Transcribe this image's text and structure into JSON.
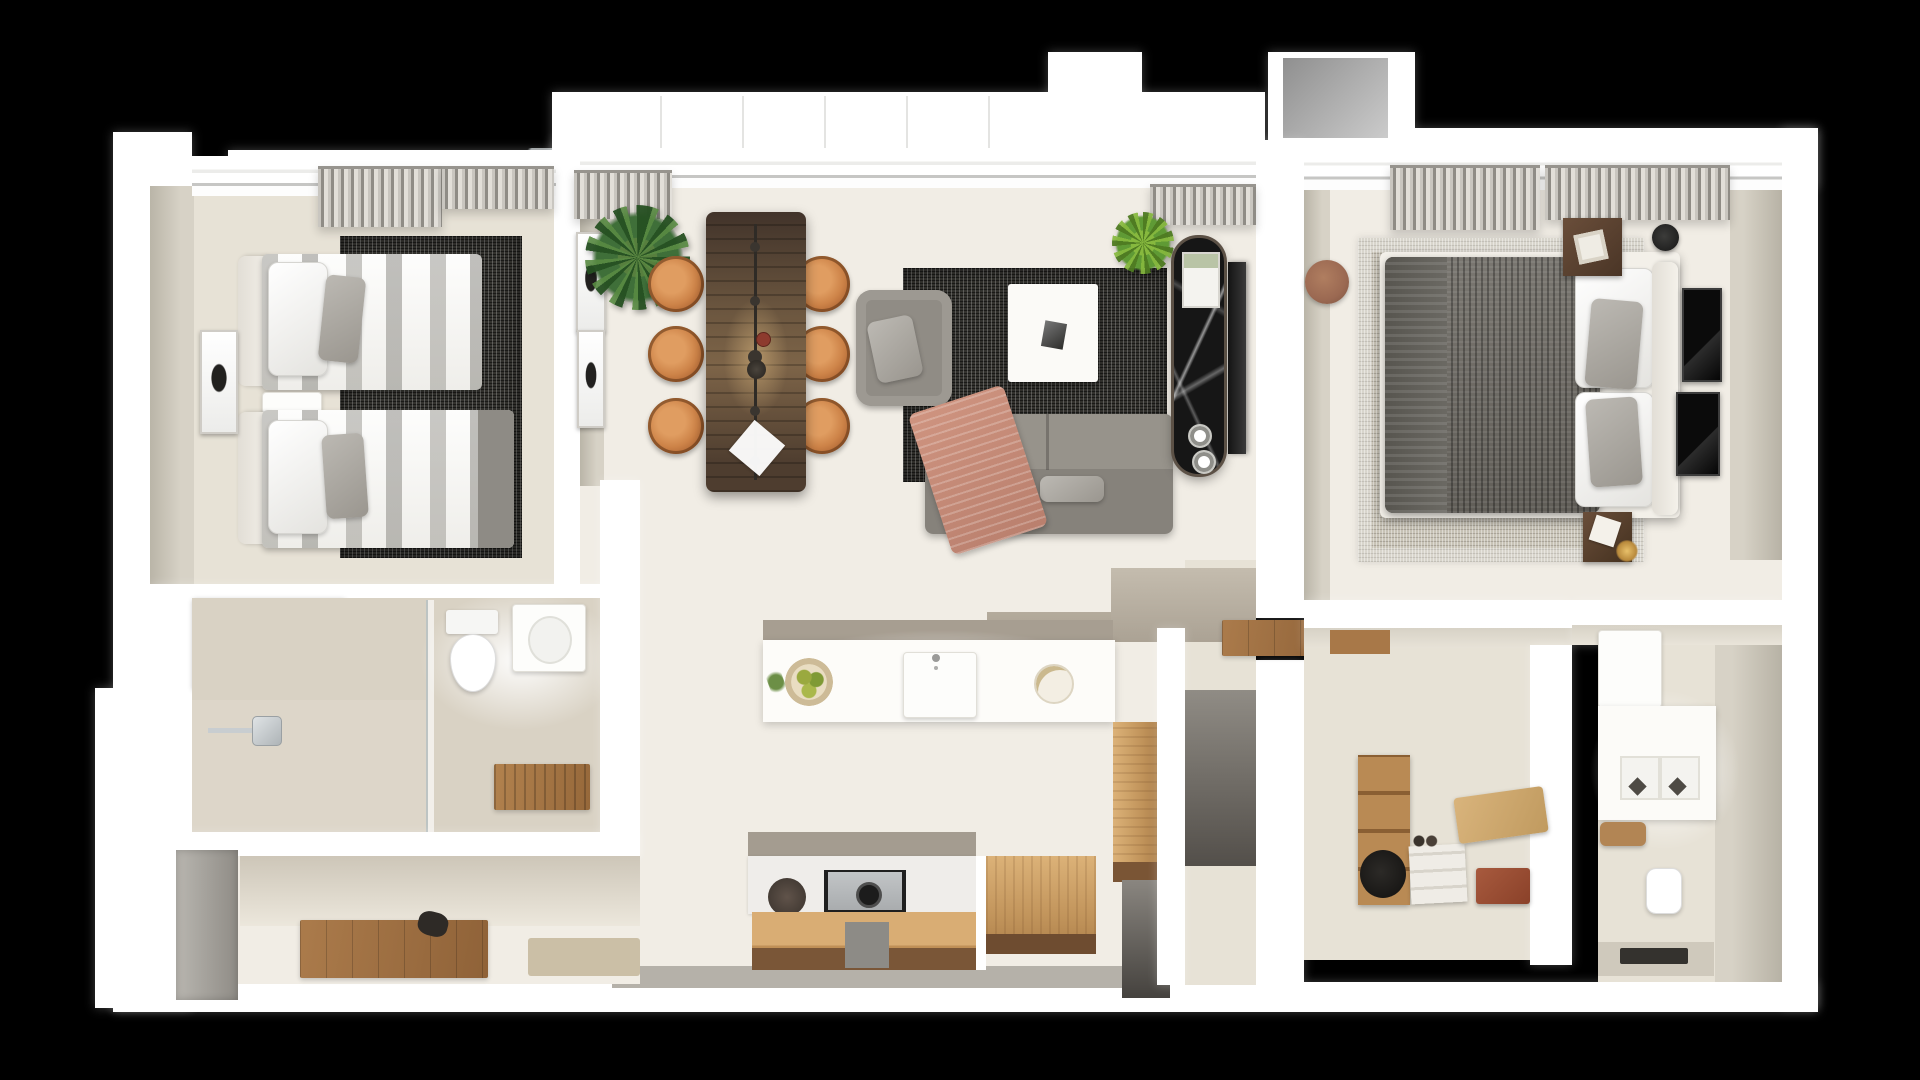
{
  "scene": {
    "description": "Top-down 3D dollhouse render of a two-bedroom apartment floor plan on a black background",
    "view": "top-down architectural render",
    "background": "#000000"
  },
  "palette": {
    "bg": "#000000",
    "wall": "#ffffff",
    "wall-face": "#d7d2c6",
    "floor": "#f1ede5",
    "floor-dim": "#e7e2d6",
    "tile": "#d9d2c4",
    "wood": "#d0a265",
    "wood-deep": "#7a5535",
    "table-wood": "#5d4a38",
    "chair-tan": "#c97f44",
    "sofa-gray": "#8b877f",
    "rug-dark": "#33322e",
    "rug-light": "#c8c3b6",
    "duvet-gray": "#6e6c66",
    "throw-blush": "#c48d7a",
    "marble-black": "#161616",
    "plant-green": "#4c7d3c",
    "plant-bright": "#76ab3a",
    "pouf-brown": "#9b6952",
    "door-gray": "#8f8c86"
  },
  "rooms": [
    {
      "id": "bedroom-2",
      "label": "Twin Bedroom",
      "furniture": [
        "twin bed x2",
        "upholstered headboards",
        "white and gray striped bedding",
        "gray accent pillows",
        "bedside shelf",
        "charcoal textured rug",
        "tall wall art",
        "gray curtains",
        "oak wardrobe"
      ]
    },
    {
      "id": "bathroom-1",
      "label": "Bathroom",
      "furniture": [
        "walk-in shower",
        "rain shower arm",
        "glass screen",
        "toilet",
        "washbasin",
        "teak duckboard mat"
      ]
    },
    {
      "id": "entry-hall",
      "label": "Entry Hall",
      "furniture": [
        "gray entry door",
        "wooden doormat",
        "keys on mat",
        "beige mat"
      ]
    },
    {
      "id": "living-dining",
      "label": "Living / Dining Room",
      "furniture": [
        "dark walnut dining table",
        "linear pendant light",
        "round tan leather chairs x6",
        "palm plant",
        "wall art x2",
        "gray armchair",
        "charcoal rug",
        "white coffee table",
        "gray sectional sofa",
        "blush throw blanket",
        "pothos plant",
        "black marble media console",
        "wall mounted tv"
      ]
    },
    {
      "id": "kitchen",
      "label": "Kitchen",
      "furniture": [
        "island with sink",
        "fruit bowl",
        "serving plate",
        "gas cooktop",
        "dark round platter",
        "oak base cabinets",
        "tall oak cabinet",
        "oak counter return",
        "dark service doorway"
      ]
    },
    {
      "id": "hallway",
      "label": "Inner Hallway",
      "furniture": [
        "oak threshold floor",
        "dark corridor doorway"
      ]
    },
    {
      "id": "walk-in-closet",
      "label": "Walk-in Closet",
      "furniture": [
        "oak desk ledge",
        "open wardrobe shelving",
        "white storage boxes",
        "black hat box",
        "red storage box",
        "oak bench step"
      ]
    },
    {
      "id": "master-bathroom",
      "label": "Master Bathroom",
      "furniture": [
        "storage cabinet",
        "double vanity with twin basins",
        "wooden stool",
        "wall-hung toilet",
        "walk-in shower with linear drain"
      ]
    },
    {
      "id": "master-bedroom",
      "label": "Master Bedroom",
      "furniture": [
        "king bed",
        "knit charcoal duvet",
        "white and gray pillows",
        "white headboard",
        "dark wood nightstand x2",
        "black floor lamp",
        "round leather pouf",
        "black wall art x2",
        "light woven rug",
        "gray curtains"
      ]
    }
  ]
}
